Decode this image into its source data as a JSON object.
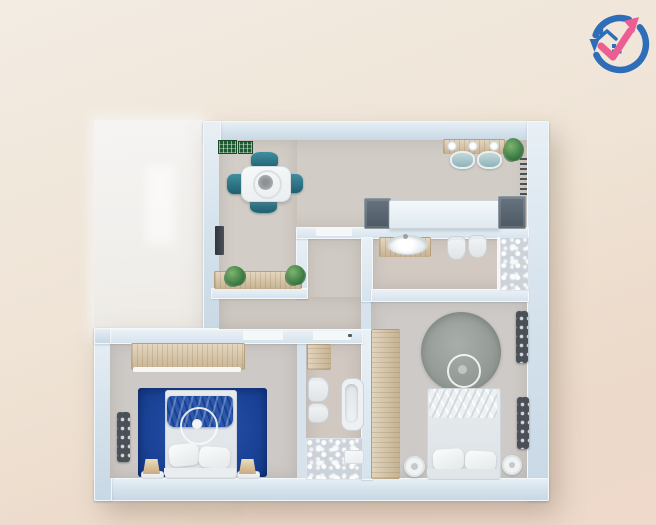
{
  "meta": {
    "title": "Top-down 3D apartment floor plan rendering",
    "canvas_width": 656,
    "canvas_height": 525
  },
  "palette": {
    "background_top": "#f3ece3",
    "background_bottom": "#eed9cb",
    "wall": "#d3e1eb",
    "wall_edge": "#f2f7fa",
    "floor": "#d2ccc6",
    "terrace_white": "#f3f2ef",
    "wood": "#d8c4a4",
    "teal_chair": "#2b7a8c",
    "blue_carpet": "#1c459a",
    "grey_rug": "#959b97",
    "appliance_grey": "#57616c",
    "plant_green": "#3a7a44",
    "logo_blue": "#2e6db8",
    "logo_pink": "#ec5d92"
  },
  "logo": {
    "label": "real-estate growth logo",
    "elements": [
      "circular blue arrow ring",
      "pink upward check arrow",
      "blue house with chimney",
      "2x2 window squares"
    ]
  },
  "rooms": {
    "living": {
      "label": "Open living / dining / kitchen",
      "furniture": [
        "two green wall frames",
        "white dining table",
        "four teal chairs",
        "dark TV panel",
        "wooden sideboard with two plants",
        "wooden breakfast bar with three plates",
        "two teal bar stools",
        "white kitchen counter",
        "two dark appliance cabinets",
        "corner plant",
        "towel rail"
      ]
    },
    "bathroom_top": {
      "label": "Bathroom with shower",
      "furniture": [
        "wooden vanity with oval sink",
        "wall-hung toilet",
        "bidet",
        "marble shower corner"
      ]
    },
    "hallway": {
      "label": "Hallway",
      "furniture": []
    },
    "corridor": {
      "label": "Corridor",
      "furniture": []
    },
    "bedroom_right": {
      "label": "Master bedroom",
      "furniture": [
        "tall wooden wardrobe",
        "round grey rug",
        "round side table",
        "double bed with duvet and two pillows",
        "two round nightstands",
        "two wall shelf units"
      ]
    },
    "bathroom_small": {
      "label": "Small bathroom",
      "furniture": [
        "wooden cabinet",
        "toilet",
        "bidet",
        "bathtub",
        "marble floor area",
        "bath mat"
      ]
    },
    "bedroom_left": {
      "label": "Blue bedroom",
      "furniture": [
        "wooden wardrobe with light strip",
        "wall radiator shelf",
        "royal blue carpet",
        "double bed with blue throw and two pillows",
        "two bedside lamps"
      ]
    },
    "terrace": {
      "label": "Terrace / unfurnished white area",
      "furniture": []
    }
  }
}
